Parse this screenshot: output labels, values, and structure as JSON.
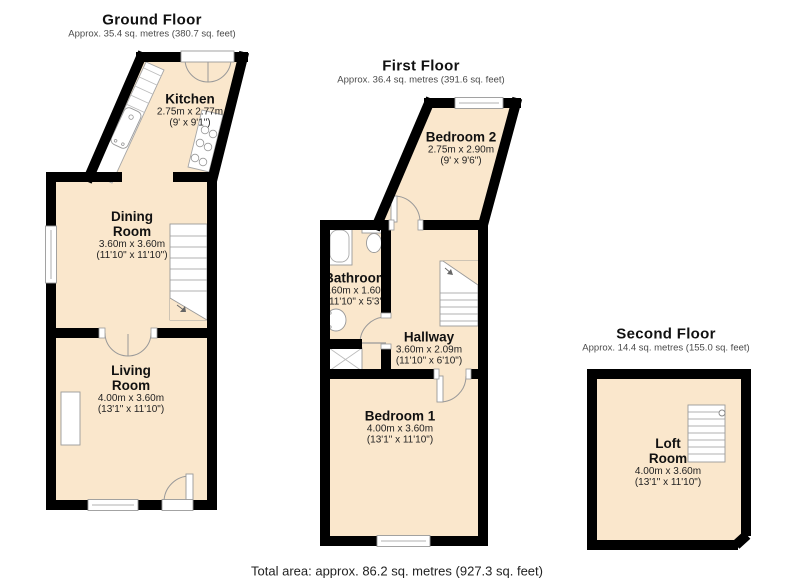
{
  "floors": [
    {
      "id": "ground",
      "title": "Ground Floor",
      "subtitle": "Approx. 35.4 sq. metres (380.7 sq. feet)",
      "rooms": [
        {
          "id": "kitchen",
          "name": "Kitchen",
          "metric": "2.75m x 2.77m",
          "imperial": "(9' x 9'1\")"
        },
        {
          "id": "dining",
          "name": "Dining Room",
          "metric": "3.60m x 3.60m",
          "imperial": "(11'10\" x 11'10\")"
        },
        {
          "id": "living",
          "name": "Living Room",
          "metric": "4.00m x 3.60m",
          "imperial": "(13'1\" x 11'10\")"
        }
      ]
    },
    {
      "id": "first",
      "title": "First Floor",
      "subtitle": "Approx. 36.4 sq. metres (391.6 sq. feet)",
      "rooms": [
        {
          "id": "bedroom2",
          "name": "Bedroom 2",
          "metric": "2.75m x 2.90m",
          "imperial": "(9' x 9'6\")"
        },
        {
          "id": "bathroom",
          "name": "Bathroom",
          "metric": "3.60m x 1.60m",
          "imperial": "(11'10\" x 5'3\")"
        },
        {
          "id": "hallway",
          "name": "Hallway",
          "metric": "3.60m x 2.09m",
          "imperial": "(11'10\" x 6'10\")"
        },
        {
          "id": "bedroom1",
          "name": "Bedroom 1",
          "metric": "4.00m x 3.60m",
          "imperial": "(13'1\" x 11'10\")"
        }
      ]
    },
    {
      "id": "second",
      "title": "Second Floor",
      "subtitle": "Approx. 14.4 sq. metres (155.0 sq. feet)",
      "rooms": [
        {
          "id": "loft",
          "name": "Loft Room",
          "metric": "4.00m x 3.60m",
          "imperial": "(13'1\" x 11'10\")"
        }
      ]
    }
  ],
  "footer": {
    "total_area": "Total area: approx. 86.2 sq. metres (927.3 sq. feet)"
  },
  "colors": {
    "floor_fill": "#FAE7CC",
    "wall": "#000000",
    "fixture_stroke": "#999999"
  }
}
